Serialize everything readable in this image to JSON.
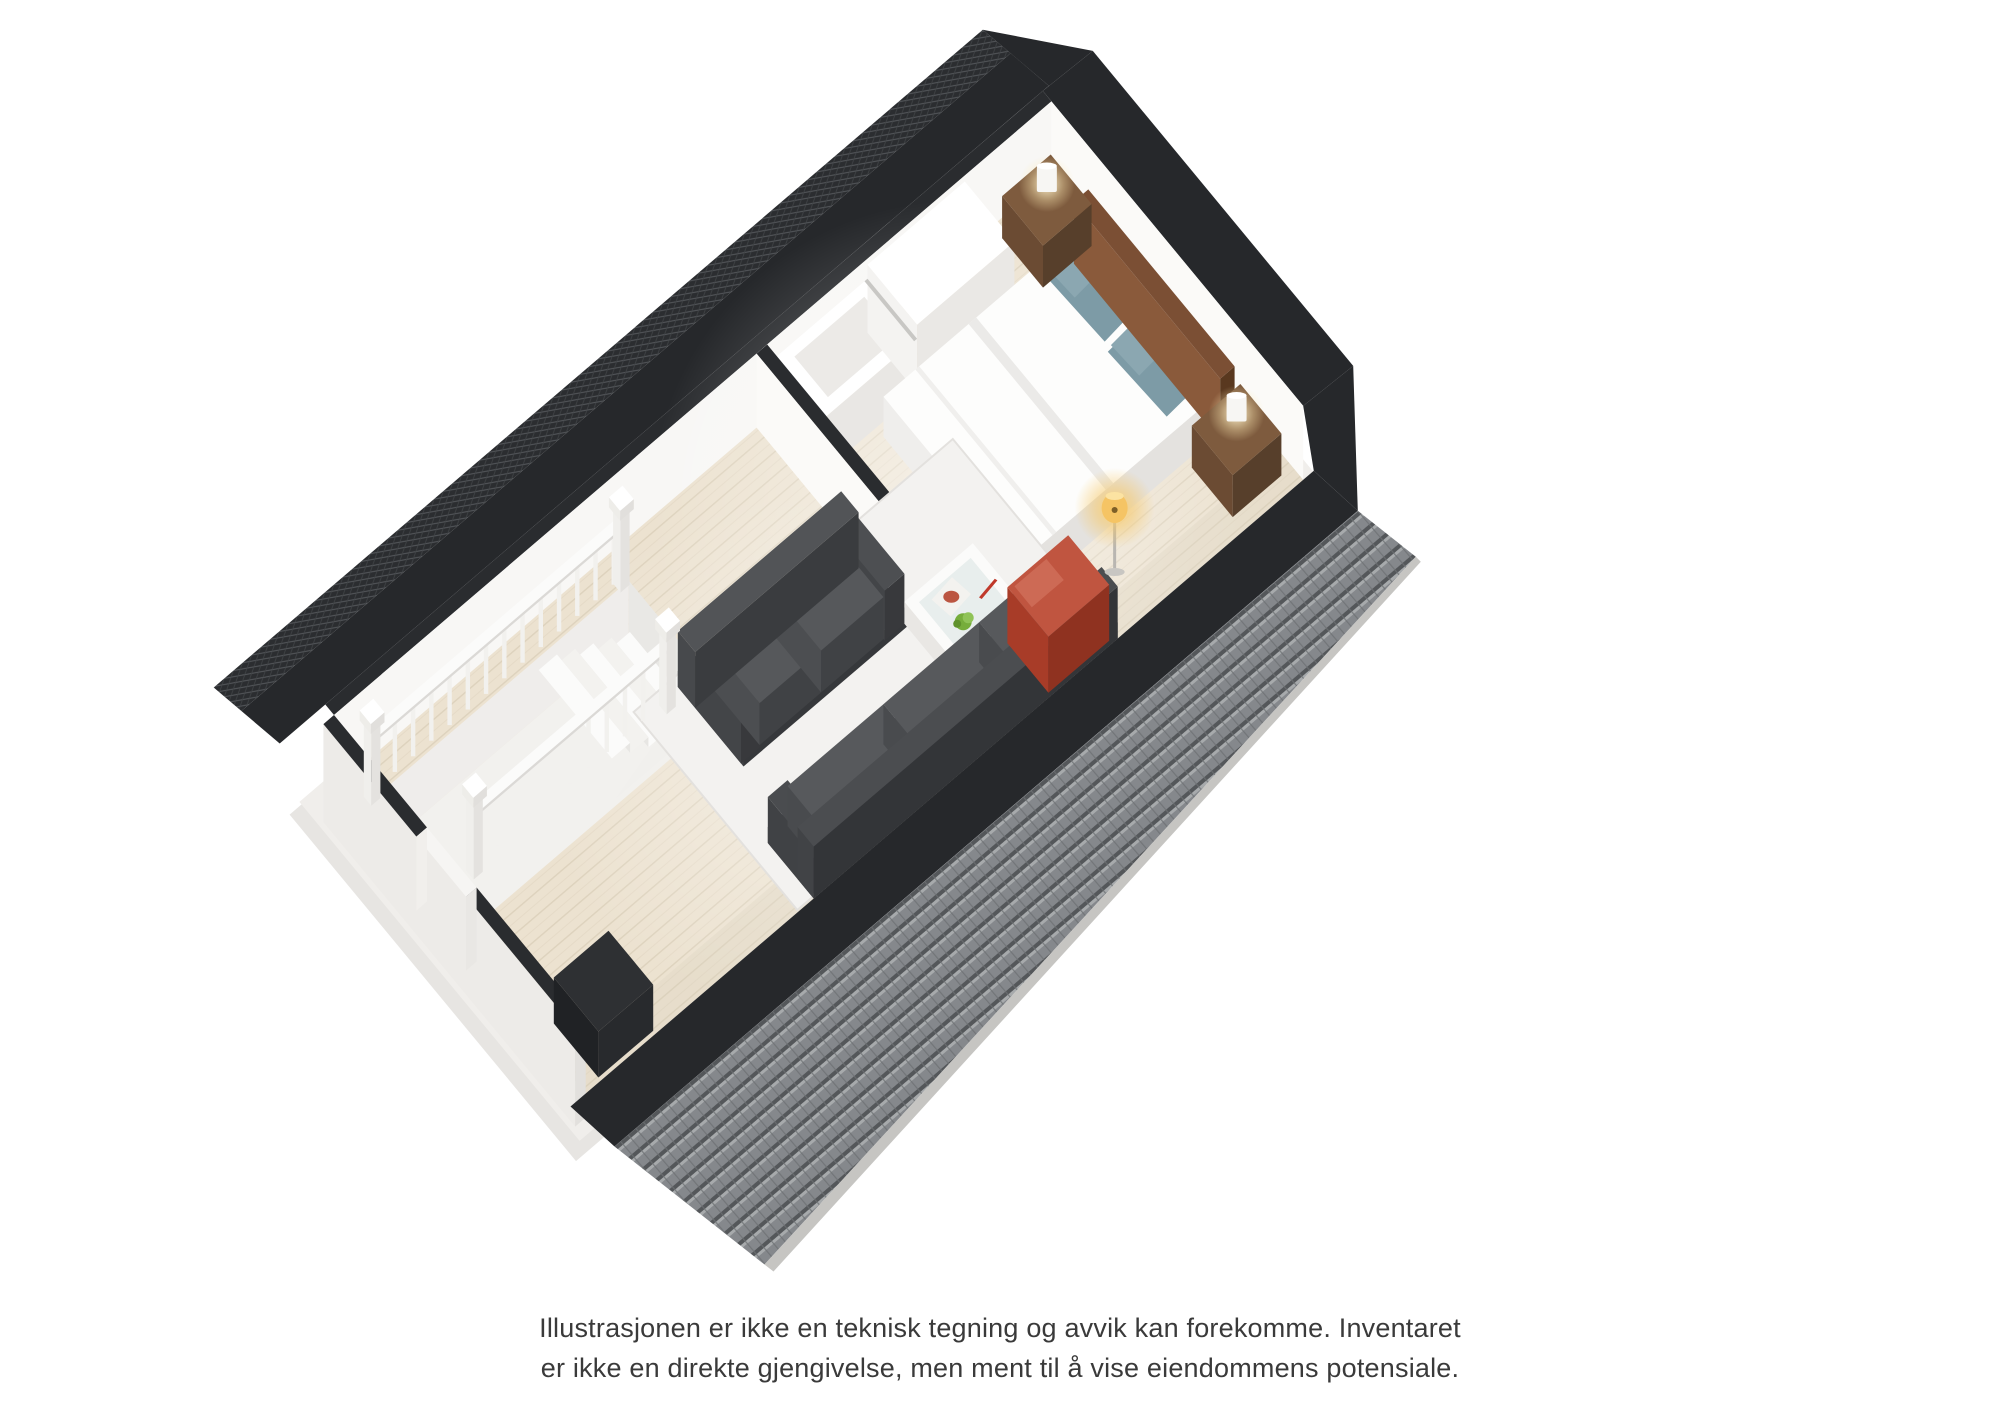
{
  "caption": {
    "line1": "Illustrasjonen er ikke en teknisk tegning og avvik kan forekomme. Inventaret",
    "line2": "er ikke en direkte gjengivelse, men ment til å vise eiendommens potensiale."
  },
  "colors": {
    "background": "#ffffff",
    "roof_dark": "#26282b",
    "roof_tile_base": "#85888c",
    "roof_tile_shadow": "#54575a",
    "roof_tile_highlight": "#a7aaac",
    "wall_face": "#f8f7f5",
    "wall_cap": "#2a2c2f",
    "floor_base": "#ece2d0",
    "floor_plank_line": "#ddd2bd",
    "sofa_body": "#46484b",
    "sofa_cushion": "#56585b",
    "accent_red": "#b5442e",
    "pillow_teal": "#7d9ba6",
    "headboard_brown": "#7b4f34",
    "nightstand_brown": "#6b4b33",
    "duvet_white": "#fdfdfc",
    "railing_white": "#fbfbfa",
    "rug": "#f3f2f0",
    "lamp_glow": "#f6c868"
  },
  "scene": {
    "type": "3d-floor-plan",
    "rooms": [
      {
        "name": "bedroom",
        "furniture": [
          "double-bed",
          "headboard",
          "teal-pillows",
          "nightstand-left",
          "nightstand-right",
          "table-lamps",
          "white-wardrobe"
        ]
      },
      {
        "name": "living-room",
        "furniture": [
          "gray-sofa",
          "chaise-sofa",
          "red-armchair",
          "coffee-table",
          "floor-lamp",
          "white-rug",
          "stair-railings",
          "staircase"
        ]
      }
    ],
    "structure": [
      "left-roof-band",
      "right-tiled-roof",
      "white-walls",
      "wood-floor",
      "chimney-block"
    ]
  }
}
